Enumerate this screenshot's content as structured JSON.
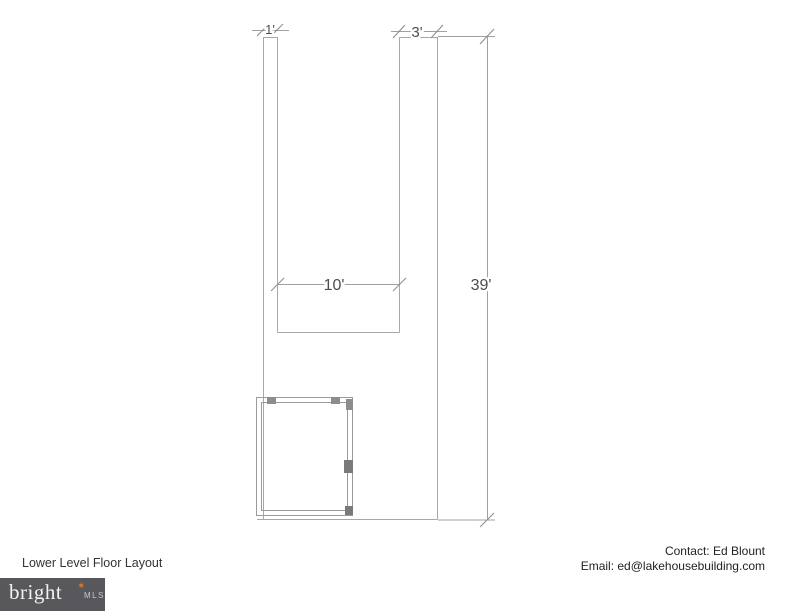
{
  "title": "Lower Level Floor Layout",
  "plan": {
    "type": "floor-plan",
    "dim_left_column_width": "1'",
    "dim_right_column_width": "3'",
    "dim_opening_width": "10'",
    "dim_total_height": "39'"
  },
  "contact": {
    "name_line": "Contact: Ed Blount",
    "email_line": "Email: ed@lakehousebuilding.com"
  },
  "logo": {
    "brand": "bright",
    "suffix": "MLS",
    "star_icon": "✶"
  },
  "colors": {
    "wall_line": "#a8a8a8",
    "dimension_text": "#4d4d4d",
    "logo_background": "#58585c",
    "logo_star": "#e87722",
    "footer_text": "#222222"
  }
}
